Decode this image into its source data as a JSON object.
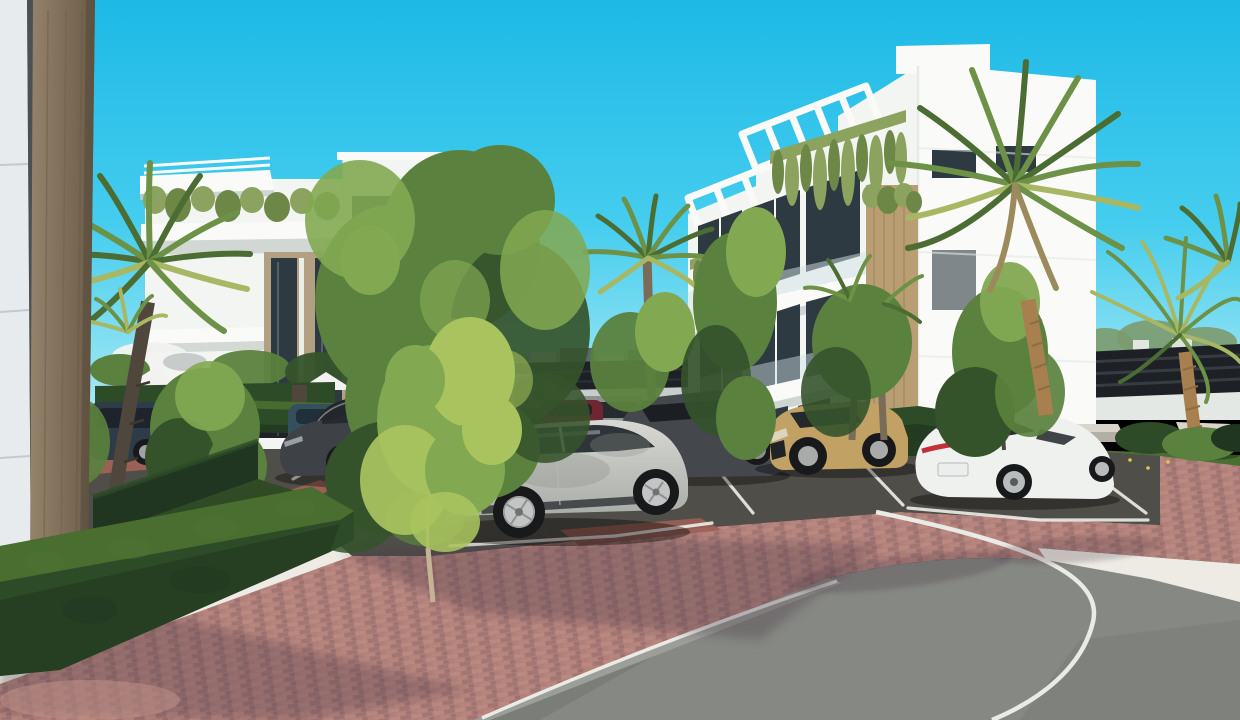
{
  "scene": {
    "type": "3d-architectural-render",
    "description": "Sunny exterior rendering of a modern white apartment complex: two white 4-storey buildings with rooftop pergolas and planted balconies, palm trees, boxwood hedges, a pink brick promenade, a dark parking bay strip with white stall lines, parked cars and a curving asphalt road.",
    "time_of_day": "day",
    "sky": "clear cyan"
  },
  "palette": {
    "sky_top": "#1db9e6",
    "sky_mid": "#45cdee",
    "sky_horizon": "#a7e9f4",
    "mountain": "#a9c3ce",
    "hill_right": "#b9cdd6",
    "city_white": "#eceeea",
    "city_mid": "#c2c8c6",
    "city_dark": "#5a6771",
    "fence_dark": "#1d2125",
    "fence_slat": "#3c434a",
    "back_road": "#c7cccd",
    "wall_white": "#f3f5f2",
    "wall_lit": "#fafbf8",
    "wall_shade": "#e3e8e4",
    "wall_under": "#c6cdc9",
    "tan_panel": "#b3a083",
    "wood_panel": "#b89e72",
    "wood_grain": "#9b8154",
    "window_dark": "#2e3a42",
    "window_glass": "#93a9b2",
    "glass_balustrade": "#d3e4e7",
    "vine_green": "#8ba35e",
    "vine_dark": "#6d8747",
    "hedge_dark": "#203620",
    "hedge_mid": "#2e4b27",
    "hedge_light": "#4d7433",
    "grass": "#4a7031",
    "grass_dark": "#2f4a24",
    "tree_dark": "#35532b",
    "tree_mid": "#5a813d",
    "tree_light": "#82a851",
    "tree_bright": "#a9c45f",
    "palm_green": "#6d9147",
    "palm_dark": "#4b6c32",
    "palm_yellow": "#a8b763",
    "trunk_dark": "#4f463c",
    "palm_trunk": "#7b6c57",
    "palm_trunk_gold": "#a87f4e",
    "trunk_pale": "#c5b395",
    "brick_mid": "#b2807a",
    "brick_light": "#c4948a",
    "brick_shadow": "#69505c",
    "brick_band": "#9c6156",
    "paver_dark": "#4f4e49",
    "curb_gray": "#9c9e99",
    "asphalt": "#868883",
    "asphalt_dark": "#6e706c",
    "gravel": "#edebe3",
    "line_white": "#ebebe5",
    "concrete": "#d9d5cb",
    "concrete_side": "#b3afa4",
    "car_navy": "#2e3c49",
    "car_teal": "#35505c",
    "car_dark": "#3e4246",
    "car_glass": "#22282d",
    "car_silver": "#d8d9d4",
    "car_silver_shade": "#a9aca7",
    "car_maroon": "#702631",
    "car_gray": "#8e9290",
    "car_dkgray": "#44484d",
    "car_tan": "#c2a264",
    "car_white": "#eff1ee",
    "tire": "#17191b",
    "rim_silver": "#c2c5c4",
    "tail_red": "#c23038",
    "chrome": "#cdd0d0",
    "shadow_tint": "#463945",
    "fg_white": "#e7ebed",
    "fg_seam": "#c3c9cd",
    "fg_wood_l": "#94836b",
    "fg_wood_r": "#6b5c49",
    "gap_dark": "#4e4f52",
    "white": "#f2f3f0",
    "dark_metal": "#1e2226"
  },
  "objects": {
    "buildings": [
      {
        "name": "left-apartment-building",
        "style": "white modern block, rooftop canopy with slats, planted balcony, tan recessed glazed bay"
      },
      {
        "name": "right-apartment-building",
        "style": "white modern block, stepped rooftop pergolas, cascading vines, vertical wood-clad bay, glass balustrade balconies"
      }
    ],
    "vehicles": [
      {
        "name": "navy-hatchback",
        "color_ref": "car_navy"
      },
      {
        "name": "teal-sedan",
        "color_ref": "car_teal"
      },
      {
        "name": "dark-grey-sedan",
        "color_ref": "car_dark"
      },
      {
        "name": "maroon-suv",
        "color_ref": "car_maroon"
      },
      {
        "name": "grey-suv",
        "color_ref": "car_gray"
      },
      {
        "name": "dark-grey-suv",
        "color_ref": "car_dkgray"
      },
      {
        "name": "silver-suv",
        "color_ref": "car_silver"
      },
      {
        "name": "tan-crossover",
        "color_ref": "car_tan"
      },
      {
        "name": "white-liftback-sedan",
        "color_ref": "car_white"
      },
      {
        "name": "background-silver-car",
        "color_ref": "back_road"
      }
    ],
    "vegetation": [
      "fan palms",
      "feather palm",
      "street trees",
      "boxwood hedges",
      "lawn",
      "hanging vines"
    ],
    "ground": [
      "pink brick paving",
      "dark parking bays with white stall lines",
      "asphalt road with white lane line",
      "white gravel strips",
      "concrete curb"
    ],
    "furniture": [
      "entrance gate",
      "sun loungers",
      "white parasols",
      "concrete benches"
    ]
  }
}
